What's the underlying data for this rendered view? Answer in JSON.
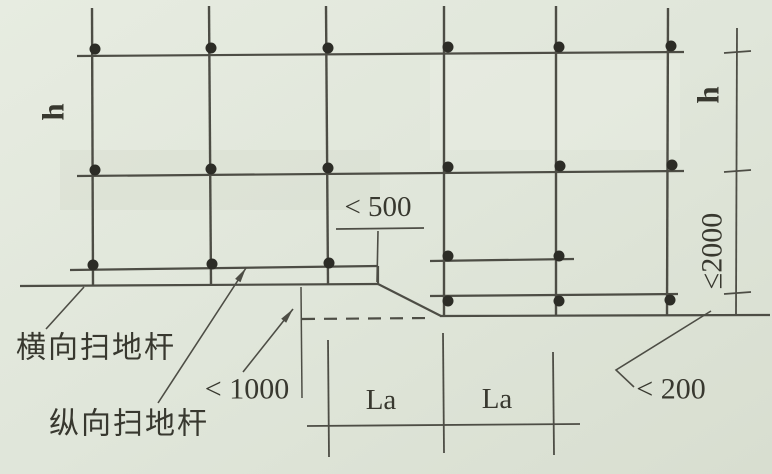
{
  "diagram": {
    "type": "scaffold-sweeping-rod-detail",
    "labels": {
      "h_left": "h",
      "h_right": "h",
      "max_bottom_lift": "≤2000",
      "lt_500": "< 500",
      "lt_1000": "< 1000",
      "lt_200": "< 200",
      "la_left": "La",
      "la_right": "La",
      "transverse_sweeping_rod": "横向扫地杆",
      "longitudinal_sweeping_rod": "纵向扫地杆"
    },
    "colors": {
      "paper": "#e2e7dc",
      "paper_dark": "#d9dfd1",
      "ink": "#4d4d45",
      "text": "#38382f",
      "joint_dot": "#2c2c26"
    }
  }
}
